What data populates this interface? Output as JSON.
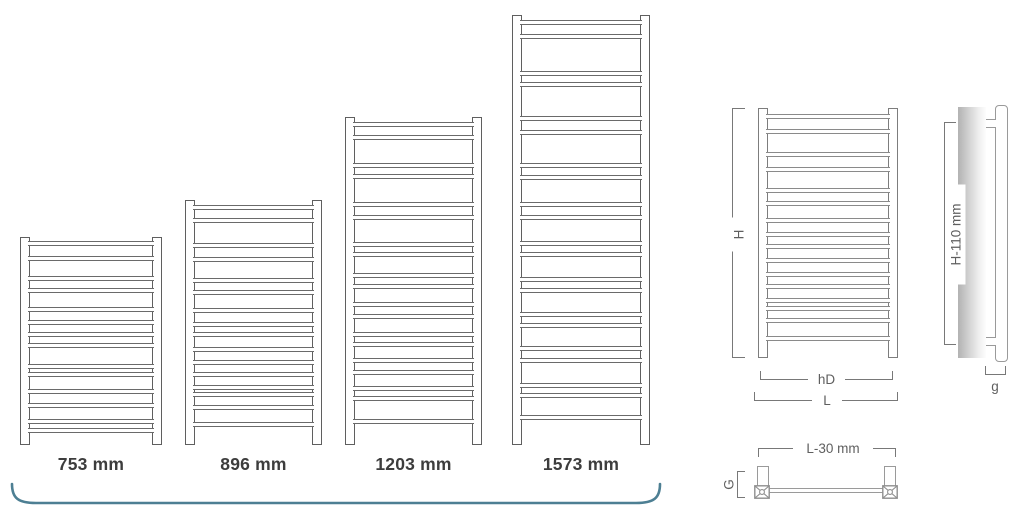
{
  "products": [
    {
      "label": "753 mm",
      "height_mm": 753
    },
    {
      "label": "896 mm",
      "height_mm": 896
    },
    {
      "label": "1203 mm",
      "height_mm": 1203
    },
    {
      "label": "1573 mm",
      "height_mm": 1573
    }
  ],
  "dimension_diagram": {
    "front_view": {
      "height_label": "H",
      "hole_distance_label": "hD",
      "width_label": "L"
    },
    "side_view": {
      "height_label": "H-110 mm",
      "depth_label": "g"
    },
    "top_view": {
      "width_label": "L-30 mm",
      "depth_label": "G"
    }
  },
  "colors": {
    "accent_bracket": "#4d7f93",
    "line_dark": "#5f5f5f",
    "line_light": "#9a9a9a",
    "text_dark": "#3d3d3d",
    "text_dim": "#5f5f5f"
  }
}
